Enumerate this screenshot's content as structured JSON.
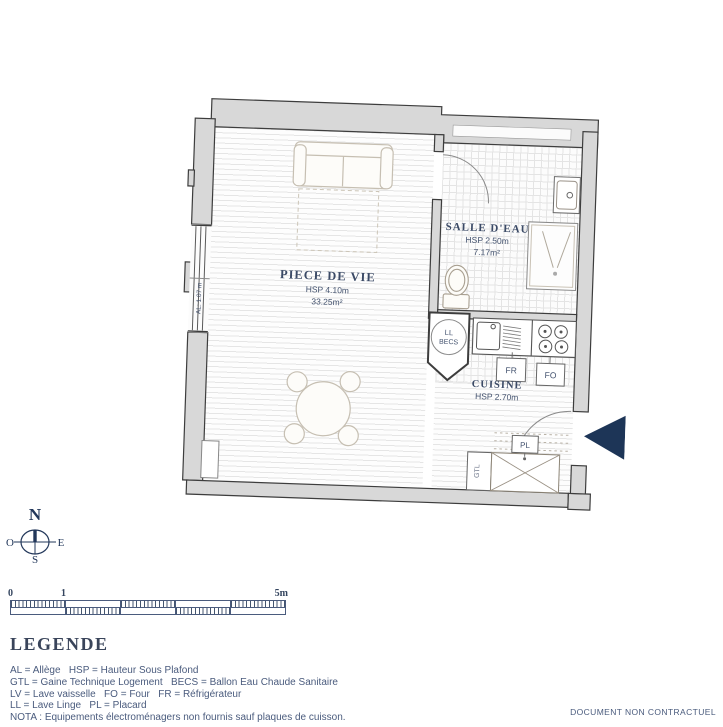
{
  "plan": {
    "rooms": {
      "living": {
        "name": "PIECE DE VIE",
        "hsp": "HSP 4.10m",
        "area": "33.25m²"
      },
      "bathroom": {
        "name": "SALLE D'EAU",
        "hsp": "HSP 2.50m",
        "area": "7.17m²"
      },
      "kitchen": {
        "name": "CUISINE",
        "hsp": "HSP 2.70m"
      }
    },
    "labels": {
      "al": "AL: 1.07 m",
      "ll": "LL",
      "becs": "BECS",
      "fr": "FR",
      "fo": "FO",
      "pl": "PL",
      "gtl": "GTL"
    }
  },
  "compass": {
    "north": "N",
    "south": "S",
    "east": "E",
    "west": "O"
  },
  "scale_bar": {
    "tick_start": "0",
    "tick_one": "1",
    "tick_end": "5m"
  },
  "legend": {
    "title": "LEGENDE",
    "lines": [
      "AL = Allège   HSP = Hauteur Sous Plafond",
      "GTL = Gaine Technique Logement   BECS = Ballon Eau Chaude Sanitaire",
      "LV = Lave vaisselle   FO = Four   FR = Réfrigérateur",
      "LL = Lave Linge   PL = Placard",
      "NOTA : Equipements électroménagers non fournis sauf plaques de cuisson."
    ]
  },
  "footer": {
    "note": "DOCUMENT NON CONTRACTUEL"
  },
  "colors": {
    "navy": "#1d3557",
    "label_text": "#44536f",
    "wall_fill": "#d8d8d8",
    "wall_stroke": "#3d3d3d"
  }
}
